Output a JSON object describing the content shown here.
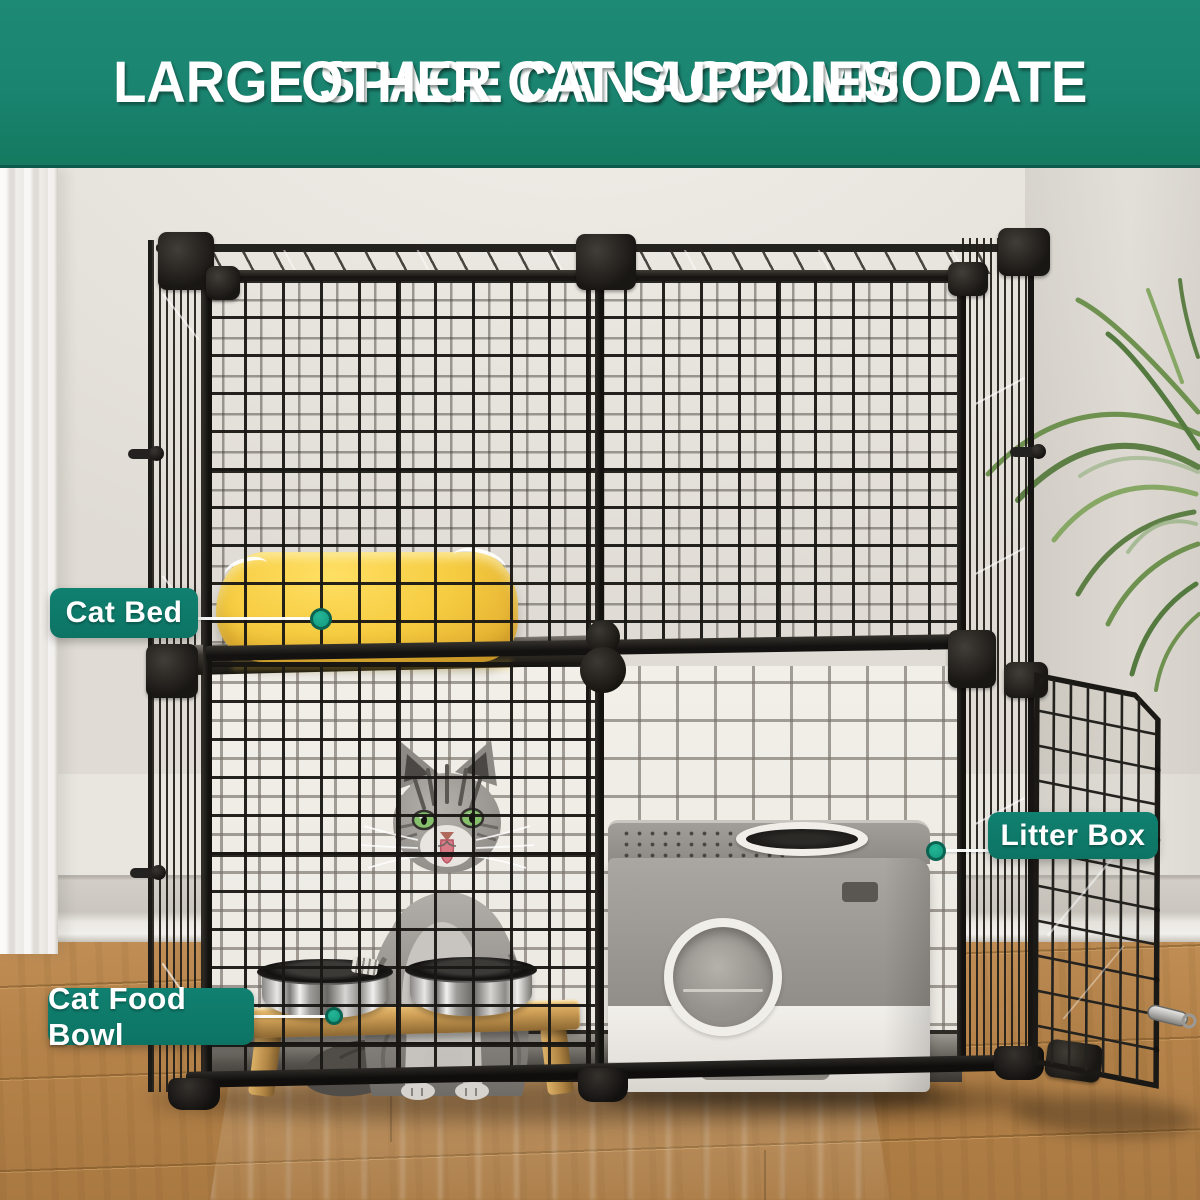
{
  "banner": {
    "line1": "LARGE SPACE CAN ACCOMMODATE",
    "line2": "OTHER CAT SUPPLIES"
  },
  "callouts": [
    {
      "label": "Cat Bed"
    },
    {
      "label": "Litter Box"
    },
    {
      "label": "Cat Food Bowl"
    }
  ],
  "colors": {
    "banner_teal": "#1A8470",
    "label_teal": "#0E7A68",
    "dot_teal": "#16A085",
    "bed_yellow": "#F5C93F",
    "wall": "#EAE7E1",
    "floor_wood": "#B9874D",
    "cage_wire": "#1C1A18",
    "litter_box_gray": "#9D9994"
  }
}
